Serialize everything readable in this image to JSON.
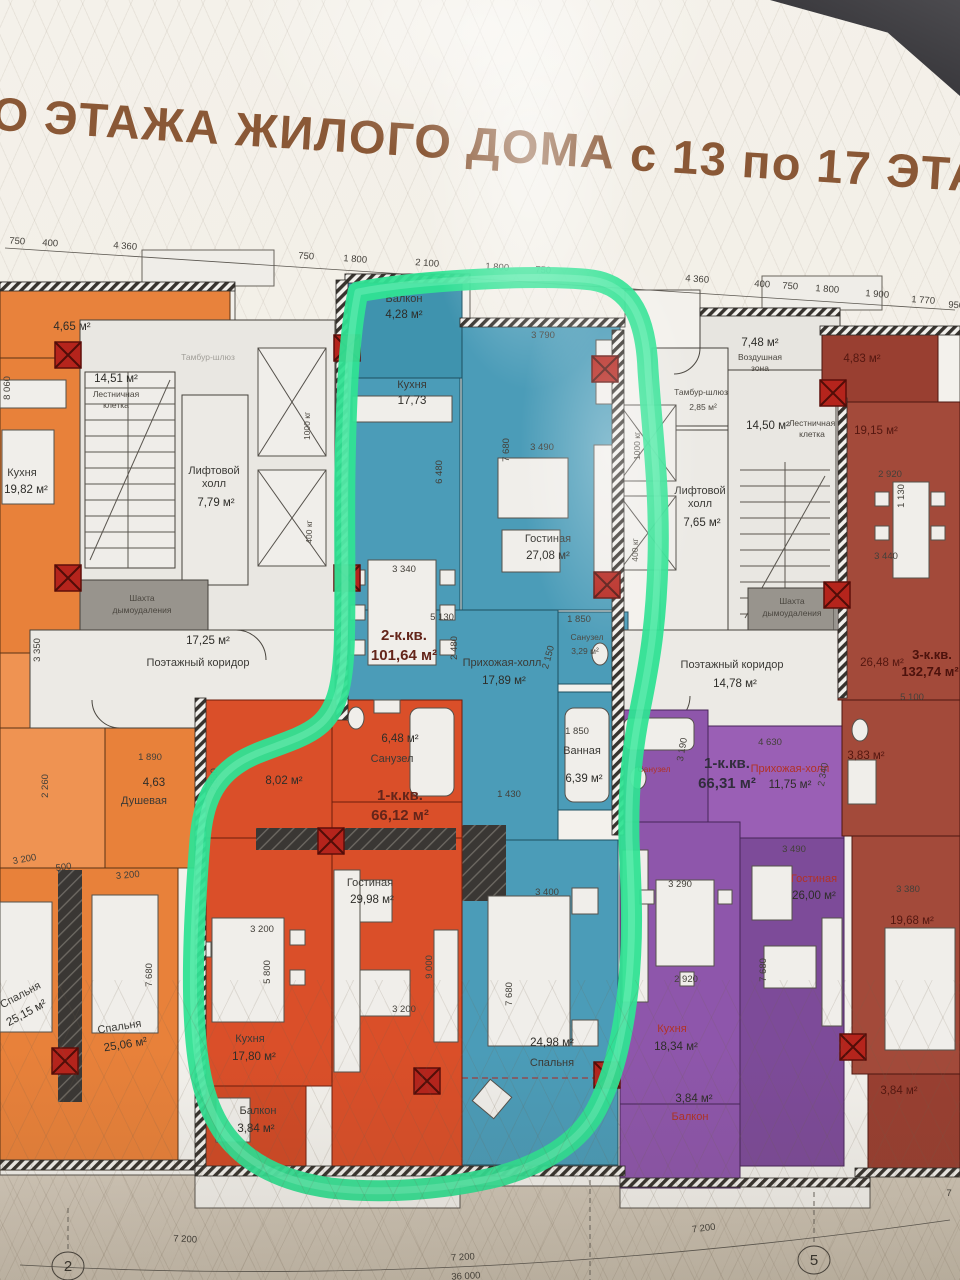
{
  "title": "ГО ЭТАЖА ЖИЛОГО ДОМА с 13 по 17 ЭТАЖ",
  "dims_top": [
    "750",
    "400",
    "4 360",
    "750",
    "1 800",
    "2 100",
    "1 800",
    "750",
    "4 360",
    "400",
    "750",
    "1 800",
    "1 900",
    "1 770",
    "950"
  ],
  "dims_bottom": {
    "left": "7 200",
    "center": "7 200",
    "right": "7 200",
    "total": "36 000",
    "cut": "7"
  },
  "axes": {
    "left": "2",
    "right": "5"
  },
  "apt_orange": {
    "balcony_area": "4,65 м²",
    "kitchen_name": "Кухня",
    "kitchen_area": "19,82 м²",
    "shower_area": "4,63",
    "shower_name": "Душевая",
    "bedroom1_name": "Спальня",
    "bedroom1_area": "25,15 м²",
    "bedroom2_name": "Спальня",
    "bedroom2_area": "25,06 м²",
    "dims": [
      "8 060",
      "3 350",
      "2 260",
      "3 200",
      "500",
      "3 200",
      "7 680",
      "1 890"
    ]
  },
  "core_left": {
    "stair_area": "14,51 м²",
    "stair_l1": "Лестничная",
    "stair_l2": "клетка",
    "tambur_name": "Тамбур-шлюз",
    "lift_l1": "Лифтовой",
    "lift_l2": "холл",
    "lift_area": "7,79 м²",
    "elev1": "1000 кг",
    "elev2": "400 кг",
    "shaft_l1": "Шахта",
    "shaft_l2": "дымоудаления",
    "corridor_area": "17,25 м²",
    "corridor_name": "Поэтажный коридор"
  },
  "apt_teal": {
    "type": "2-к.кв.",
    "total": "101,64 м²",
    "balcony_name": "Балкон",
    "balcony_area": "4,28 м²",
    "kitchen_name": "Кухня",
    "kitchen_area": "17,73",
    "living_name": "Гостиная",
    "living_area": "27,08 м²",
    "hall_name": "Прихожая-холл",
    "hall_area": "17,89 м²",
    "wc_name": "Санузел",
    "wc_area": "3,29 м²",
    "bath_name": "Ванная",
    "bath_area": "6,39 м²",
    "bedroom_area": "24,98 м²",
    "bedroom_name": "Спальня",
    "dims": [
      "3 790",
      "6 480",
      "7 680",
      "3 490",
      "3 340",
      "5 130",
      "2 480",
      "2 150",
      "1 850",
      "1 850",
      "1 430",
      "3 400",
      "7 680"
    ]
  },
  "apt_red": {
    "type": "1-к.кв.",
    "total": "66,12 м²",
    "wc_area": "6,48 м²",
    "wc_name": "Санузел",
    "hall_area": "8,02 м²",
    "living_name": "Гостиная",
    "living_area": "29,98 м²",
    "kitchen_name": "Кухня",
    "kitchen_area": "17,80 м²",
    "balcony_name": "Балкон",
    "balcony_area": "3,84 м²",
    "dims": [
      "2 630",
      "3 200",
      "5 800",
      "3 200",
      "9 000"
    ]
  },
  "core_right": {
    "air_area": "7,48 м²",
    "air_l1": "Воздушная",
    "air_l2": "зона",
    "tambur_name": "Тамбур-шлюз",
    "tambur_area": "2,85 м²",
    "stair_area": "14,50 м²",
    "stair_l1": "Лестничная",
    "stair_l2": "клетка",
    "lift_l1": "Лифтовой",
    "lift_l2": "холл",
    "lift_area": "7,65 м²",
    "elev1": "1000 кг",
    "elev2": "400 кг",
    "shaft_l1": "Шахта",
    "shaft_l2": "дымоудаления",
    "corridor_name": "Поэтажный коридор",
    "corridor_area": "14,78 м²"
  },
  "apt_purple": {
    "type": "1-к.кв.",
    "total": "66,31 м²",
    "hall_name": "Прихожая-холл",
    "hall_area": "11,75 м²",
    "wc_name": "Санузел",
    "living_name": "Гостиная",
    "living_area": "26,00 м²",
    "kitchen_name": "Кухня",
    "kitchen_area": "18,34 м²",
    "balcony_name": "Балкон",
    "balcony_area": "3,84 м²",
    "dims": [
      "4 630",
      "3 190",
      "2 340",
      "3 490",
      "3 290",
      "2 920",
      "7 680"
    ]
  },
  "apt_darkred": {
    "type": "3-к.кв.",
    "total": "132,74 м²",
    "balcony_top_area": "4,83 м²",
    "kitchen_area": "19,15 м²",
    "room1_area": "26,48 м²",
    "wc_area": "3,83 м²",
    "room2_area": "19,68 м²",
    "balcony_bottom_area": "3,84 м²",
    "dims": [
      "2 920",
      "1 130",
      "3 440",
      "5 100",
      "3 380"
    ]
  }
}
